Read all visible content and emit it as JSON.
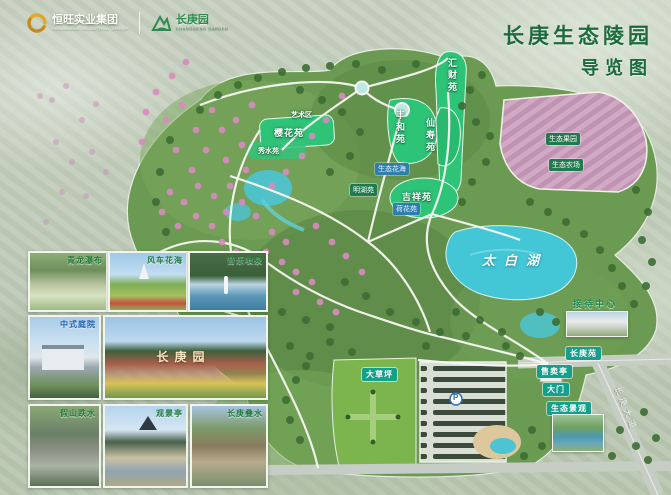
{
  "header": {
    "company_logo": {
      "name": "恒旺实业集团",
      "tagline": "HENGWANG INDUSTRIAL GROUP"
    },
    "park_logo": {
      "name": "长庚园",
      "tagline": "CHANGGENG GARDEN"
    },
    "title_line1": "长庚生态陵园",
    "title_line2": "导览图"
  },
  "map": {
    "lake_label": "太白湖",
    "road_label": "长庚大道",
    "parking_symbol": "P",
    "areas": [
      {
        "label": "汇财苑"
      },
      {
        "label": "丰和苑"
      },
      {
        "label": "仙寿苑"
      },
      {
        "label": "吉祥苑"
      },
      {
        "label": "樱花苑"
      },
      {
        "label": "秀水苑"
      },
      {
        "label": "艺术区"
      },
      {
        "label": "明湖苑"
      },
      {
        "label": "生态花海"
      },
      {
        "label": "荷花苑"
      },
      {
        "label": "生态果园"
      },
      {
        "label": "生态农场"
      }
    ],
    "facilities": [
      {
        "label": "接待中心"
      },
      {
        "label": "长庚苑"
      },
      {
        "label": "生态景观"
      },
      {
        "label": "售卖亭"
      },
      {
        "label": "大门"
      },
      {
        "label": "大草坪"
      }
    ]
  },
  "photos": {
    "captions": [
      "青龙瀑布",
      "风车花海",
      "音乐喷泉",
      "中式庭院",
      "假山跌水",
      "观景亭",
      "长庚叠水"
    ],
    "gate_sign": "长庚园"
  },
  "colors": {
    "title_green": "#1b6b3c",
    "zone_green": "#2ec478",
    "lake_cyan": "#43c6d6",
    "farm_pink": "#d2a9c4",
    "badge_teal": "#14a08c"
  }
}
